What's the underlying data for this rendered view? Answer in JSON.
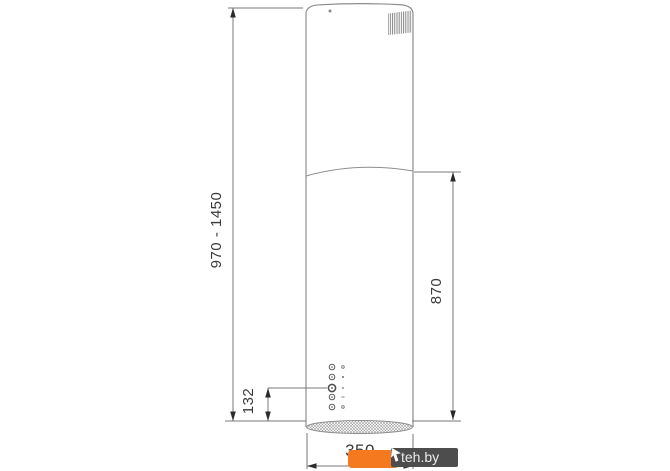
{
  "diagram": {
    "title": "cooker-hood-dimension-drawing",
    "subject": "cylindrical island range hood, front view with dimensions",
    "dimensions": {
      "total_height": "970 - 1450",
      "body_height": "870",
      "controls_offset": "132",
      "bottom_width": "350"
    },
    "controls": {
      "button_count": 5,
      "highlighted_button_index": 3
    },
    "icons": {
      "vent": "louver-hatch-grille",
      "bottom_filter": "mesh-crosshatch-ellipse",
      "arrows": "filled-dimension-arrowheads"
    },
    "colors": {
      "outline": "#8e8e8e",
      "dimension_line": "#7a7a7a",
      "arrow": "#2b2b2b",
      "text": "#3a3a3a",
      "background": "#ffffff"
    }
  },
  "watermark": {
    "label": "teh.by",
    "badge_color": "#f4791f",
    "plate_color": "#4d4d4d",
    "text_color": "#ebebeb",
    "pointer_icon": "cursor-arrow"
  }
}
